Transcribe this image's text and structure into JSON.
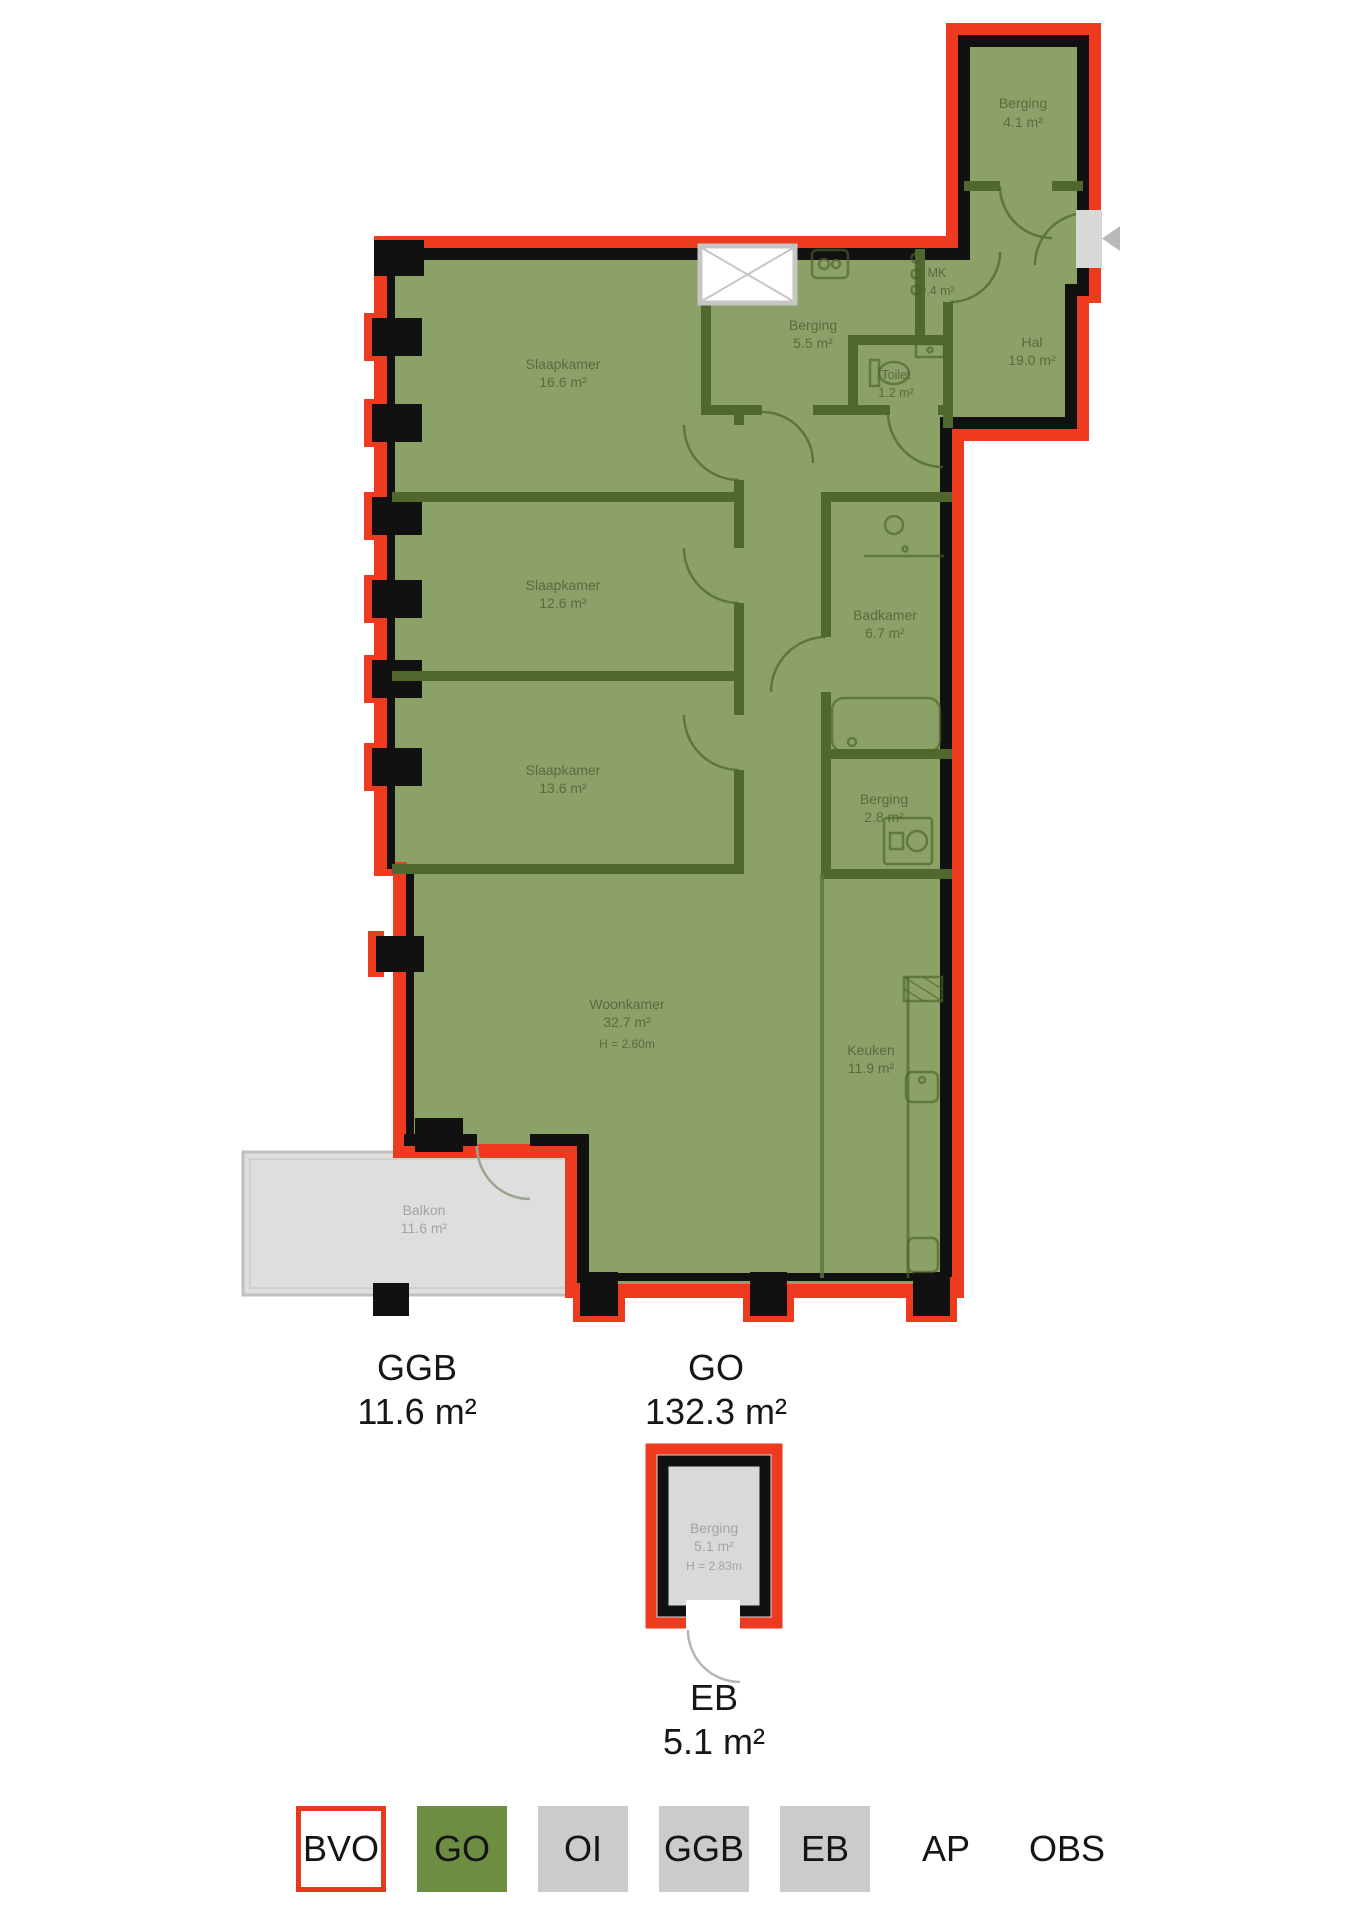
{
  "plan": {
    "rooms": [
      {
        "name": "Berging",
        "area": "4.1 m²"
      },
      {
        "name": "MK",
        "area": "0.4 m²"
      },
      {
        "name": "Hal",
        "area": "19.0 m²"
      },
      {
        "name": "Berging",
        "area": "5.5 m²"
      },
      {
        "name": "Toilet",
        "area": "1.2 m²"
      },
      {
        "name": "Slaapkamer",
        "area": "16.6 m²"
      },
      {
        "name": "Slaapkamer",
        "area": "12.6 m²"
      },
      {
        "name": "Slaapkamer",
        "area": "13.6 m²"
      },
      {
        "name": "Badkamer",
        "area": "6.7 m²"
      },
      {
        "name": "Berging",
        "area": "2.8 m²"
      },
      {
        "name": "Woonkamer",
        "area": "32.7 m²",
        "ceiling": "H = 2.60m"
      },
      {
        "name": "Keuken",
        "area": "11.9 m²"
      },
      {
        "name": "Balkon",
        "area": "11.6 m²"
      },
      {
        "name": "Berging",
        "area": "5.1 m²",
        "ceiling": "H = 2.83m"
      }
    ],
    "totals": [
      {
        "code": "GGB",
        "area": "11.6 m²"
      },
      {
        "code": "GO",
        "area": "132.3 m²"
      },
      {
        "code": "EB",
        "area": "5.1 m²"
      }
    ],
    "legend": {
      "items": [
        {
          "label": "BVO"
        },
        {
          "label": "GO"
        },
        {
          "label": "OI"
        },
        {
          "label": "GGB"
        },
        {
          "label": "EB"
        },
        {
          "label": "AP"
        },
        {
          "label": "OBS"
        }
      ]
    },
    "colors": {
      "bvo_red": "#ee3a1f",
      "floor_green": "#8ca168",
      "wall_green": "#50682e",
      "wall_black": "#111111",
      "legend_green": "#6d8d41",
      "legend_gray": "#cbcbcb",
      "balkon_gray": "#dedede",
      "label_gray": "#a3a3a3"
    }
  }
}
